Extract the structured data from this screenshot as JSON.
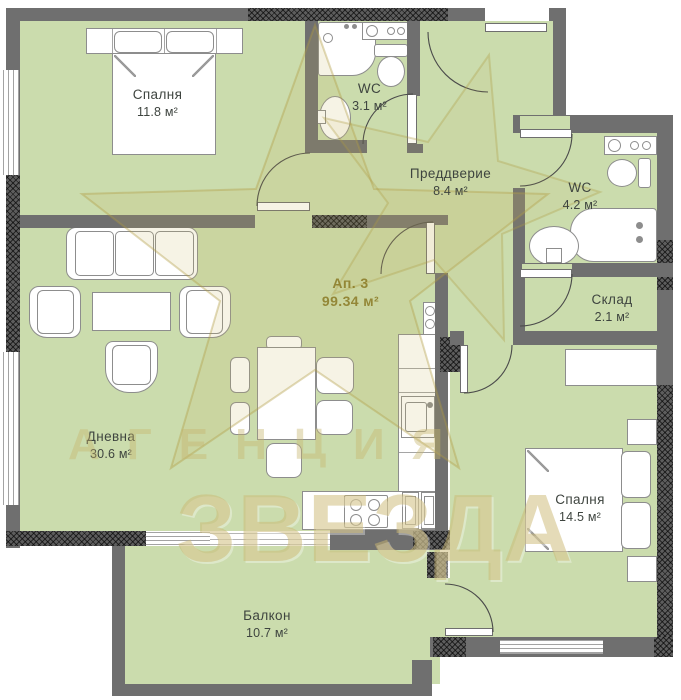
{
  "plan": {
    "title_block": {
      "apartment": "Ап. 3",
      "apartment_area": "99.34 м²"
    },
    "rooms": {
      "bedroom1": {
        "name": "Спалня",
        "area": "11.8 м²"
      },
      "wc1": {
        "name": "WC",
        "area": "3.1 м²"
      },
      "hallway": {
        "name": "Преддверие",
        "area": "8.4 м²"
      },
      "wc2": {
        "name": "WC",
        "area": "4.2 м²"
      },
      "storage": {
        "name": "Склад",
        "area": "2.1 м²"
      },
      "living": {
        "name": "Дневна",
        "area": "30.6 м²"
      },
      "bedroom2": {
        "name": "Спалня",
        "area": "14.5 м²"
      },
      "balcony": {
        "name": "Балкон",
        "area": "10.7 м²"
      }
    },
    "watermark": {
      "agency": "АГЕНЦИЯ",
      "star": "ЗВЕЗДА"
    },
    "colors": {
      "floor": "#cbdcad",
      "wall": "#6f6f6f",
      "furn": "#8d8d8d",
      "label": "#3e443f",
      "accent": "#8a7a25",
      "watermark": "#c8b271"
    }
  }
}
